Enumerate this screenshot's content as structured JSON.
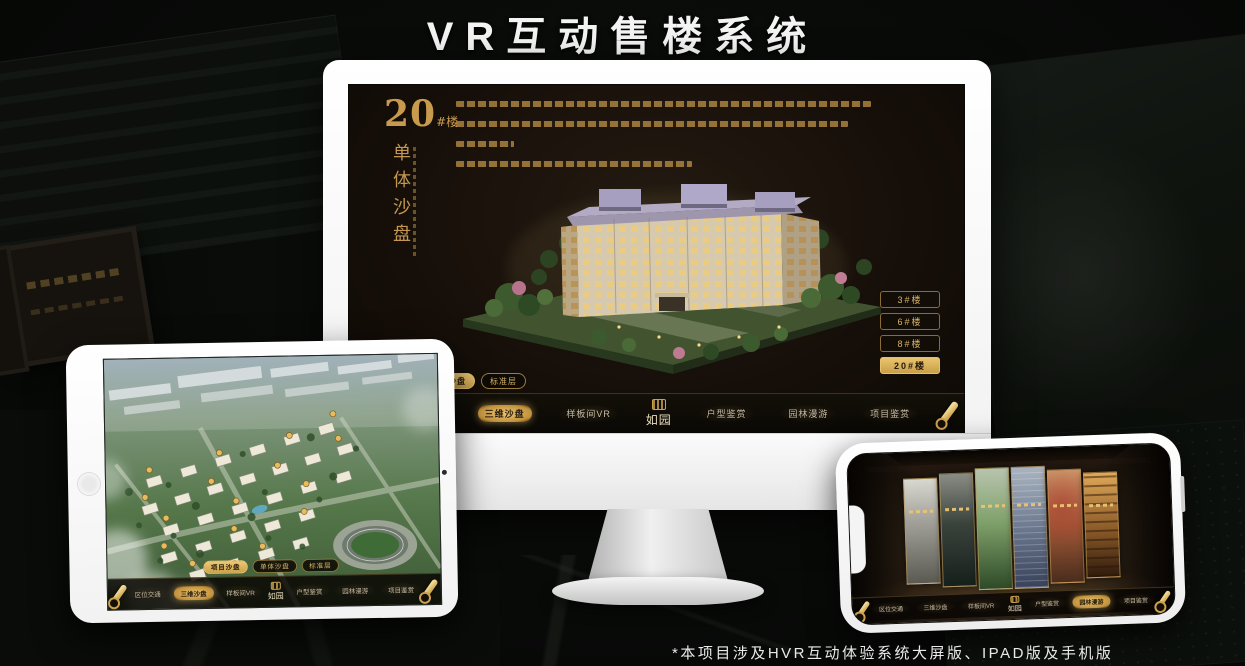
{
  "page": {
    "title": "VR互动售楼系统",
    "footnote": "*本项目涉及HVR互动体验系统大屏版、IPAD版及手机版"
  },
  "colors": {
    "gold": "#d2a95e",
    "gold_bright": "#ecc671",
    "gold_text": "#c89a4e",
    "active_text": "#241a0c",
    "screen_bg": "#170f09",
    "nav_bg": "#0a0805",
    "title_white": "#f4f4f4"
  },
  "nav": {
    "logo": "如园",
    "items": [
      "区位交通",
      "三维沙盘",
      "样板间VR",
      "户型鉴赏",
      "园林漫游",
      "项目鉴赏"
    ]
  },
  "tabs": [
    "项目沙盘",
    "单体沙盘",
    "标准层"
  ],
  "monitor": {
    "headline_number": "20",
    "headline_unit": "#楼",
    "headline_subtitle": "单体沙盘",
    "floors": [
      "3#楼",
      "6#楼",
      "8#楼",
      "20#楼"
    ],
    "active_floor": "20#楼",
    "active_tab": "单体沙盘",
    "active_nav": "三维沙盘"
  },
  "tablet": {
    "active_tab": "项目沙盘",
    "active_nav": "三维沙盘"
  },
  "phone": {
    "active_nav": "园林漫游"
  }
}
